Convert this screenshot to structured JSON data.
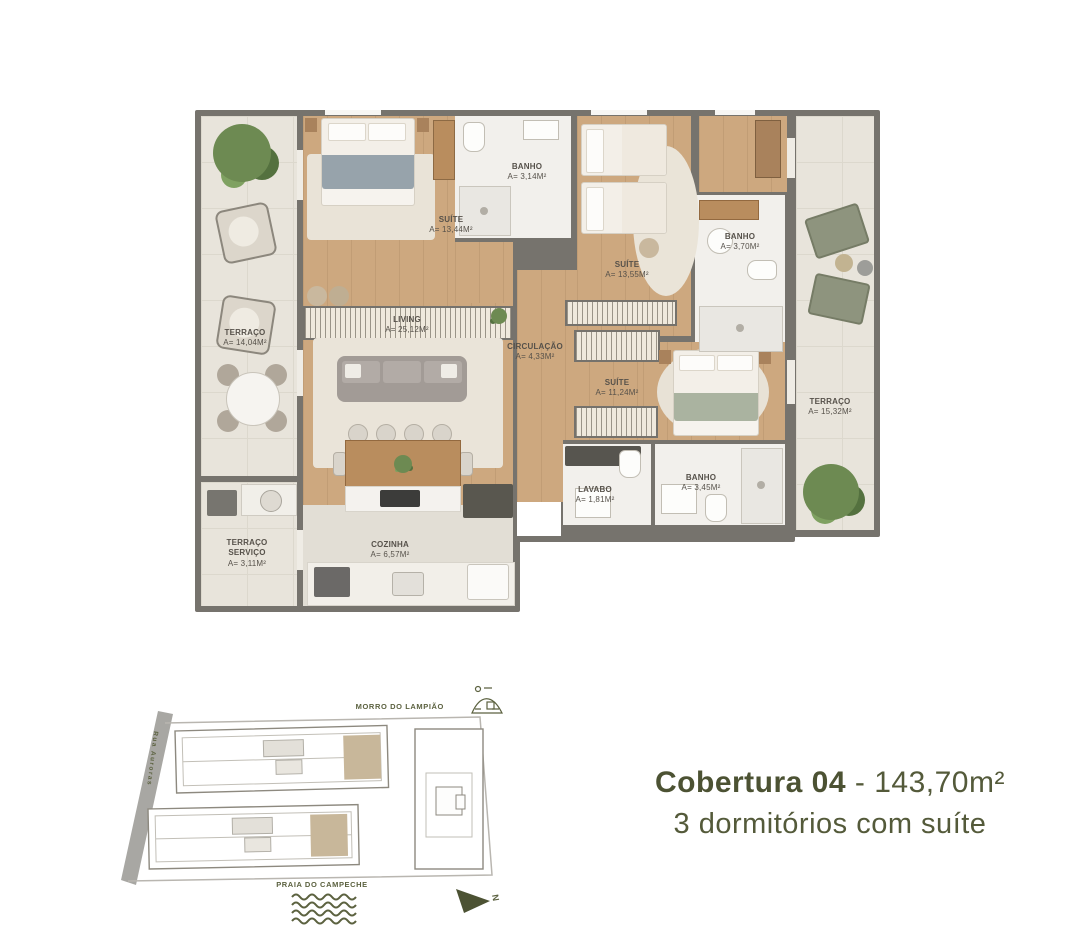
{
  "title": {
    "unit": "Cobertura 04",
    "separator": " - ",
    "area": "143,70m²",
    "subtitle": "3 dormitórios com suíte"
  },
  "floorplan": {
    "rooms": {
      "terraco": {
        "name": "TERRAÇO",
        "area": "A= 14,04m²"
      },
      "suite1": {
        "name": "SUÍTE",
        "area": "A= 13,44m²"
      },
      "banho1": {
        "name": "BANHO",
        "area": "A= 3,14m²"
      },
      "suite2": {
        "name": "SUÍTE",
        "area": "A= 13,55m²"
      },
      "banho2": {
        "name": "BANHO",
        "area": "A= 3,70m²"
      },
      "living": {
        "name": "LIVING",
        "area": "A= 25,12m²"
      },
      "circulacao": {
        "name": "CIRCULAÇÃO",
        "area": "A= 4,33m²"
      },
      "suite3": {
        "name": "SUÍTE",
        "area": "A= 11,24m²"
      },
      "terraco2": {
        "name": "TERRAÇO",
        "area": "A= 15,32m²"
      },
      "cozinha": {
        "name": "COZINHA",
        "area": "A= 6,57m²"
      },
      "terraco_servico": {
        "name": "TERRAÇO SERVIÇO",
        "area": "A= 3,11m²"
      },
      "lavabo": {
        "name": "LAVABO",
        "area": "A= 1,81m²"
      },
      "banho3": {
        "name": "BANHO",
        "area": "A= 3,45m²"
      }
    }
  },
  "siteplan": {
    "morro": "MORRO DO LAMPIÃO",
    "praia": "PRAIA DO CAMPECHE",
    "street": "Rua Auroras",
    "north": "N"
  },
  "colors": {
    "accent_olive": "#4c5233",
    "wall": "#76736d",
    "wood_floor": "#cda87f",
    "terrace_tile": "#e8e4db",
    "bath_floor": "#f2f0ec",
    "unit_highlight": "#c8b79a"
  }
}
